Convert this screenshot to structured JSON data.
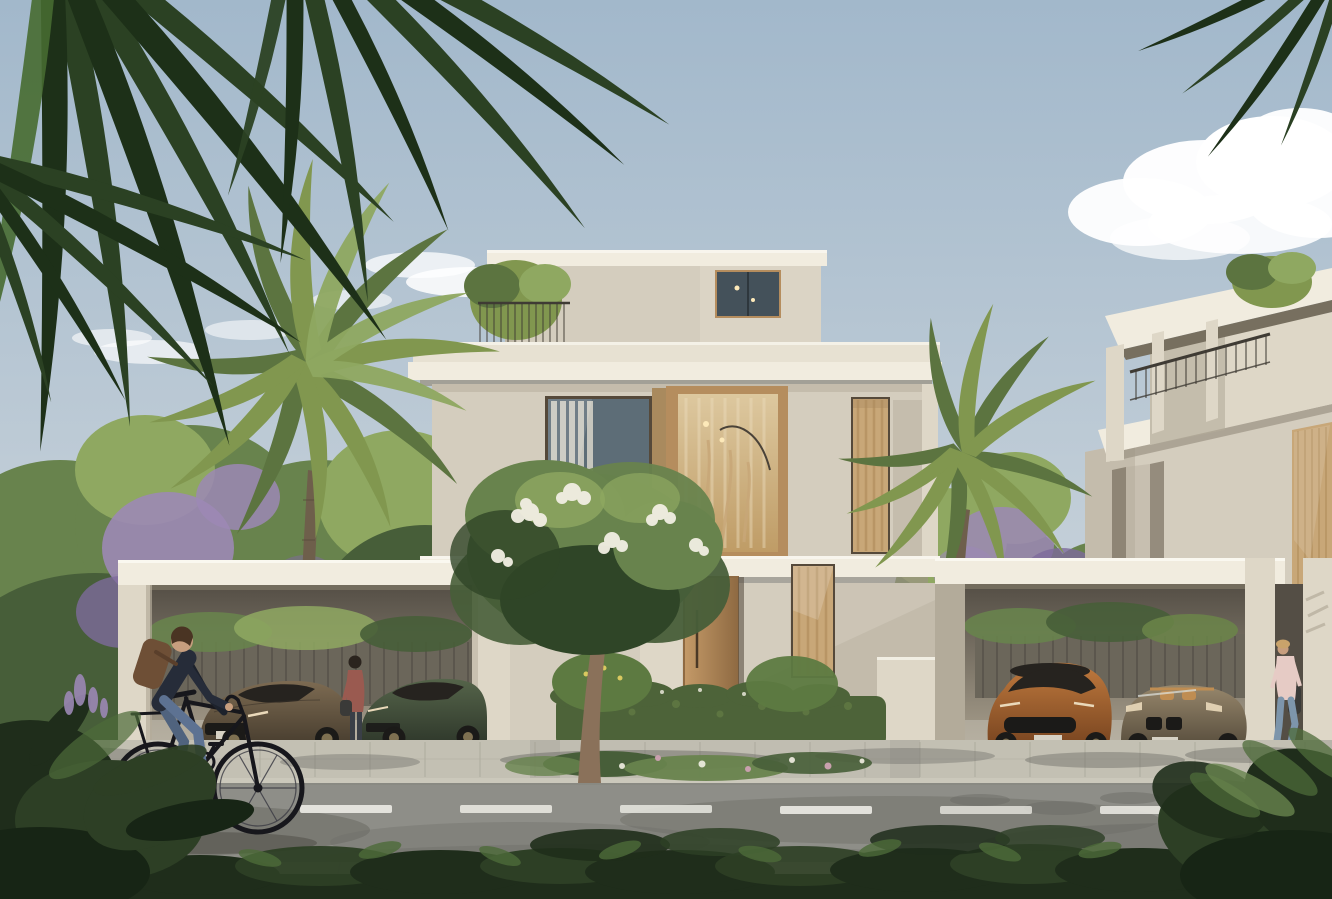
{
  "meta": {
    "title": "Architectural rendering - modern villas street view",
    "description": "Photorealistic architectural rendering: two modern three-storey cream villas with open carports, four luxury cars, palm trees, a flowering frangipani tree, a man cycling past on the street, a woman standing by a green car and a woman walking at the right, blue sky with clouds, road with white dashed lane marking, dark shrubs in the foreground."
  },
  "scene": {
    "setting": "sunny residential street, daytime",
    "buildings": [
      {
        "name": "central villa",
        "storeys": 3,
        "style": "modern flat-roof, cream stucco, warm wood window frames, roof terrace with railing and plant"
      },
      {
        "name": "right villa",
        "storeys": 3,
        "style": "modern flat-roof seen at an angle, balcony railing, terrace plant, tall curtained window"
      }
    ],
    "vehicles": [
      {
        "name": "brown sports coupe",
        "location": "left carport",
        "body_color": "#6b5a44"
      },
      {
        "name": "dark green sports sedan",
        "location": "left carport",
        "body_color": "#47553b"
      },
      {
        "name": "orange sports SUV",
        "location": "right carport",
        "body_color": "#b06a33"
      },
      {
        "name": "bronze convertible roadster",
        "location": "right carport",
        "body_color": "#8a7a64"
      }
    ],
    "people": [
      {
        "name": "cyclist",
        "detail": "man in dark navy shirt, blue jeans, brown backpack, riding a black bicycle left of frame"
      },
      {
        "name": "woman standing",
        "detail": "woman in maroon top standing between the cars of the left carport"
      },
      {
        "name": "woman walking",
        "detail": "woman in pink top and light blue jeans walking at the right carport"
      }
    ],
    "vegetation": [
      "overhanging dark palm fronds top-left and top-right",
      "tall date palm left of centre",
      "second palm between the villas",
      "background tree line with purple blossoms",
      "white-flowering frangipani tree at the entrance",
      "clipped hedges",
      "dark foreground shrubs"
    ],
    "street": {
      "lane_marking": "white dashed centre line",
      "surfaces": [
        "paved sidewalk",
        "asphalt road",
        "paved lower sidewalk"
      ]
    }
  },
  "colors": {
    "sky_top": "#a2b8cb",
    "sky_horizon": "#d8dde0",
    "cloud": "#ffffff",
    "foliage_light": "#8fa861",
    "foliage_mid": "#68834d",
    "foliage_dark": "#475e39",
    "canopy_deep": "#2f4527",
    "blossom_purple": "#9c88b5",
    "blossom_purple_dark": "#7d6a9b",
    "palm_mid": "#81974f",
    "palm_dark": "#5c7440",
    "palm_trunk": "#6e5f4b",
    "trunk_shade": "#57483a",
    "frond_dark": "#2b4123",
    "frond_darker": "#1d3018",
    "frond_olive": "#476b31",
    "wall_lit": "#ded7c7",
    "wall_mid": "#d4cdbe",
    "wall_shadow": "#b3ab9a",
    "fascia": "#f1ecdf",
    "fascia_hi": "#faf8f0",
    "fascia_shadow": "#9b9383",
    "parapet": "#e7e1d2",
    "roof_under": "#776f5f",
    "pilaster_dark": "#8e8575",
    "wood": "#b58d5e",
    "wood_dark": "#8f6a42",
    "pilaster": "#a98a5e",
    "door_hi": "#c49a68",
    "glass_dark": "#44515a",
    "glass_blue": "#5d6d77",
    "curtain_white": "#eae4d6",
    "curtain_warm": "#c8a778",
    "curtain_fold": "#b08d5c",
    "interior_hi": "#ddc89f",
    "interior_lo": "#bf9c66",
    "lamp": "#fde9b9",
    "frame_dark": "#55493a",
    "railing": "#3f3b34",
    "carport_top": "#544e45",
    "carport_back": "#a89f8d",
    "fence": "#6b665a",
    "slat": "#57534a",
    "car_brown_hi": "#7d6b52",
    "car_brown_lo": "#453b2d",
    "car_green_hi": "#55644a",
    "car_green_lo": "#2e372a",
    "car_orange_hi": "#c07a3e",
    "car_orange_lo": "#76431f",
    "car_bronze_hi": "#97876c",
    "car_bronze_lo": "#554b3b",
    "car_glass": "#26231f",
    "wheel": "#1b1a18",
    "rim": "#8a7a58",
    "plate": "#d6d1c4",
    "headlight": "#ead9ba",
    "seat_tan": "#bf8d52",
    "car_shadow": "#2e2a25",
    "road": "#8e8e88",
    "road_shadow": "#6c6c66",
    "lane": "#e8e7e0",
    "sidewalk": "#b6b3a8",
    "sidewalk_low": "#a8a69b",
    "paver": "#9d9a8e",
    "curb": "#cbc8bb",
    "curb_shadow": "#77756c",
    "driveway": "#c5c2b5",
    "shrub_deep": "#172515",
    "shrub_dark": "#1f2d1b",
    "shrub_mid": "#2d3f25",
    "shrub_light": "#4d6b39",
    "hedge": "#4d6339",
    "hedge_hi": "#6b8549",
    "bush": "#5d7a41",
    "flower_yellow": "#d9c960",
    "flower_pink": "#c9a0ae",
    "blossom_white": "#f2efe3",
    "tree_trunk": "#8a715a",
    "skin": "#c79e7e",
    "hair_brown": "#4a3423",
    "hair_dark": "#2b241e",
    "hair_blonde": "#c9a36b",
    "shirt_navy": "#262c39",
    "shirt_navy_dark": "#1d222c",
    "jeans": "#5d7292",
    "jeans_dark": "#50637e",
    "shoe": "#23211e",
    "backpack": "#6e4f36",
    "strap": "#5a3f2b",
    "maroon": "#9a5a50",
    "pants_dark": "#3a3f47",
    "pink": "#e6cbc5",
    "jeans_light": "#7d95ab",
    "shoe_white": "#e8e6e0",
    "bag_dark": "#3a3a38",
    "bike": "#17171c",
    "spoke": "#3c3c44",
    "shadow": "#4c4a44"
  }
}
